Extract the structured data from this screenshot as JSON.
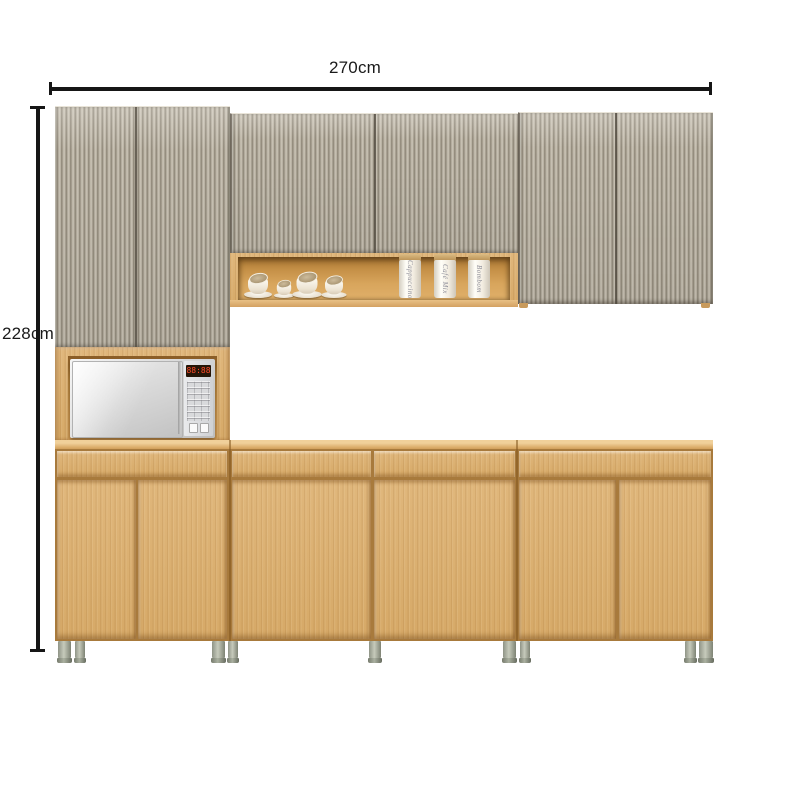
{
  "product_diagram": {
    "width_annotation": "270cm",
    "height_annotation": "228cm"
  },
  "colors": {
    "annotation_line": "#161616",
    "background": "#ffffff",
    "wood": "#d9ad6f",
    "wood_carcass": "#a87a3c",
    "wood_top_edge": "#f0d09a",
    "fluted_door_light": "#d0c9bb",
    "fluted_door_dark": "#8e8677",
    "shelf_interior": "#c48f46",
    "metal_foot": "#a9ad9d",
    "microwave_silver": "#e8e8e8",
    "microwave_display_digits": "#ff4b28"
  },
  "microwave": {
    "display_text": "88:88"
  },
  "open_shelf": {
    "cups_count": 4,
    "canisters": [
      {
        "label": "Cappuccino"
      },
      {
        "label": "Café Mix"
      },
      {
        "label": "Bombom"
      }
    ]
  }
}
